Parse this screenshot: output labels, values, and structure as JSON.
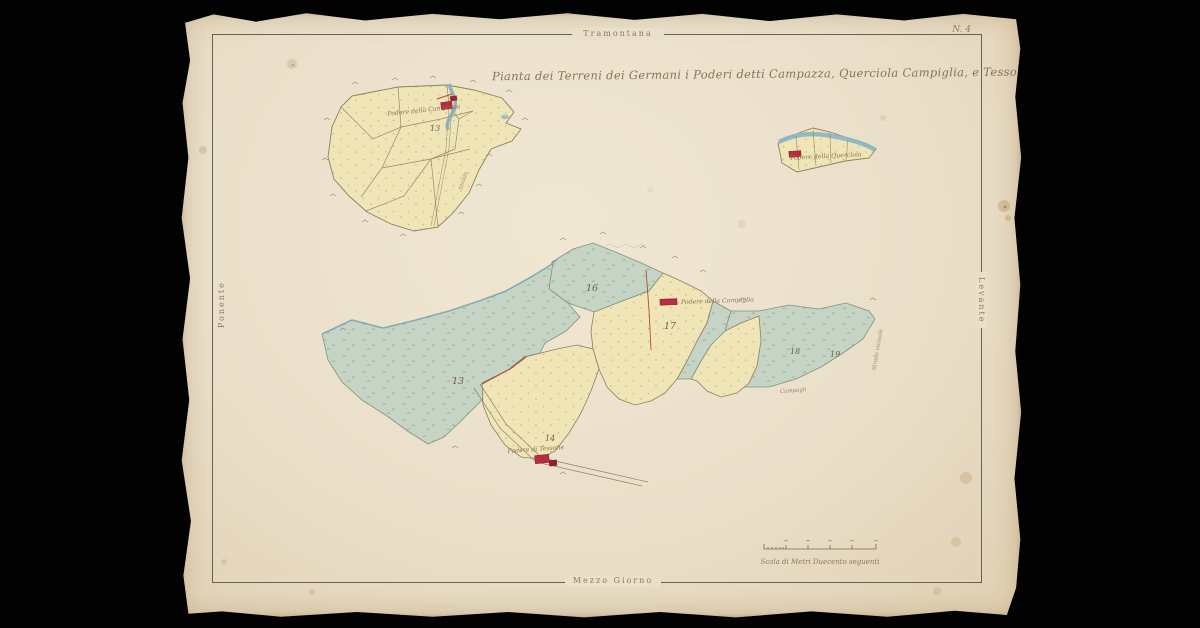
{
  "plate": {
    "number": "N. 4"
  },
  "map": {
    "title": "Pianta dei Terreni dei Germani i Poderi detti Campazza, Querciola Campiglia, e Tessone",
    "compass": {
      "north": "Tramontana",
      "south": "Mezzo Giorno",
      "west": "Ponente",
      "east": "Levante"
    },
    "farms": {
      "campazza": "Podere della Campazza",
      "querciola": "Podere della Querciola",
      "campiglia": "Podere della Campiglia",
      "tessone": "Podere di Tessone"
    },
    "parcels": {
      "ul13": "13",
      "wood13": "13",
      "wood16": "16",
      "center17": "17",
      "right18": "18",
      "right19": "19",
      "tessone14": "14"
    },
    "annotations": {
      "campagli": "Campagli",
      "road_right": "Strada vicinale",
      "road_ul": "Strada"
    },
    "scale_caption": "Scala di Metri Duecento seguenti"
  },
  "colors": {
    "background": "#020202",
    "paper": "#eadfc9",
    "ink": "#8b7a5f",
    "parcel_yellow": "#f0e5b6",
    "woodland_green": "#c6d4c5",
    "water_blue": "#85b2c4",
    "building_red": "#b72c3e",
    "boundary_red": "#b04f36"
  }
}
